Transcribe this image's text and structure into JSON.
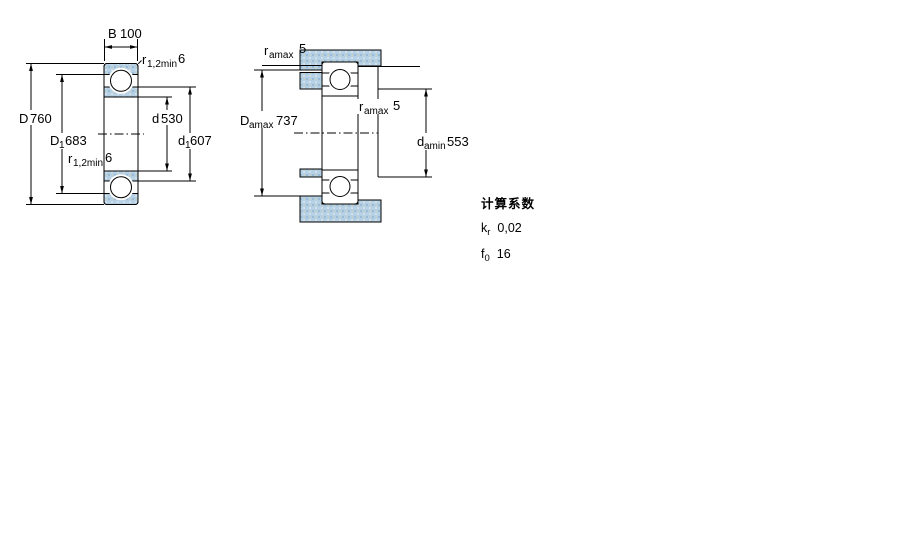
{
  "figure_left": {
    "dim_B": {
      "base": "B",
      "value": "100"
    },
    "dim_r_top": {
      "base": "r",
      "sub": "1,2min",
      "value": "6"
    },
    "dim_D": {
      "base": "D",
      "value": "760"
    },
    "dim_D1": {
      "base": "D",
      "sub": "1",
      "value": "683"
    },
    "dim_d": {
      "base": "d",
      "value": "530"
    },
    "dim_d1": {
      "base": "d",
      "sub": "1",
      "value": "607"
    },
    "dim_r_bottom": {
      "base": "r",
      "sub": "1,2min",
      "value": "6"
    }
  },
  "figure_right": {
    "dim_ra_top": {
      "base": "r",
      "sub": "amax",
      "value": "5"
    },
    "dim_Da": {
      "base": "D",
      "sub": "amax",
      "value": "737"
    },
    "dim_ra_mid": {
      "base": "r",
      "sub": "amax",
      "value": "5"
    },
    "dim_da": {
      "base": "d",
      "sub": "amin",
      "value": "553"
    }
  },
  "calculation_factors": {
    "title": "计算系数",
    "rows": [
      {
        "base": "k",
        "sub": "r",
        "value": "0,02"
      },
      {
        "base": "f",
        "sub": "0",
        "value": "16"
      }
    ]
  },
  "colors": {
    "section_fill_base": "#b5cfe3",
    "section_fill_dark": "#9abbd8",
    "section_fill_light": "#d3e1ee",
    "line": "#000000"
  }
}
